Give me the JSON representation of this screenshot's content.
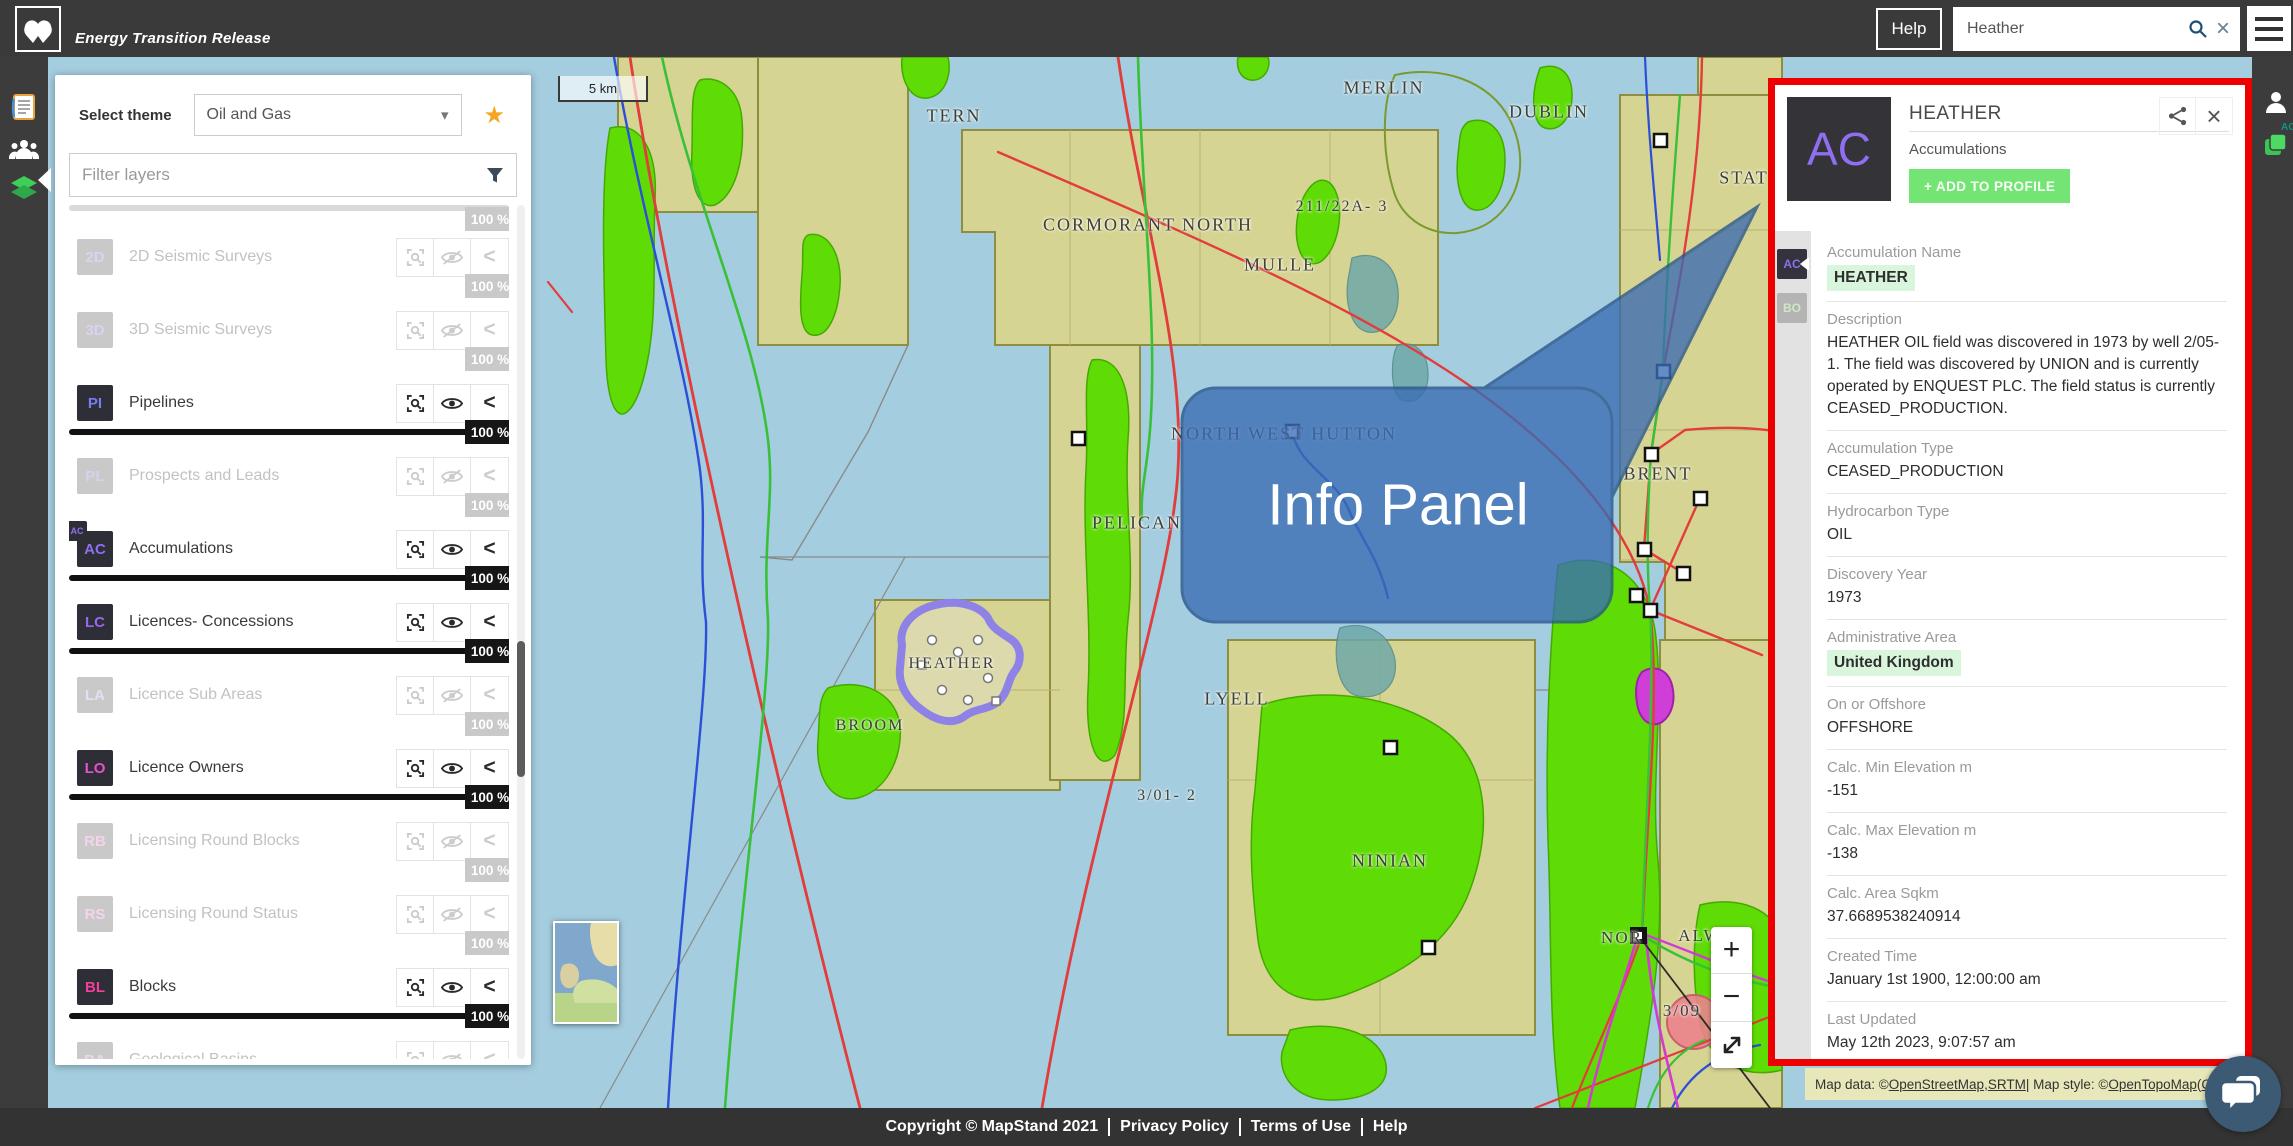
{
  "topbar": {
    "app_title": "Energy Transition Release",
    "help_label": "Help",
    "search": {
      "value": "Heather",
      "placeholder": ""
    }
  },
  "icons": {
    "menu-icon": "hamburger-three-bars",
    "search-icon": "magnifier",
    "clear-icon": "×",
    "dropdown-chevron": "▾",
    "star-icon": "★",
    "filter-icon": "funnel",
    "share-icon": "share-nodes",
    "close-icon": "×",
    "chevron-left": "<",
    "zoom-in": "+",
    "zoom-out": "−",
    "expand-icon": "diagonal-arrows",
    "document-icon": "report-page",
    "people-icon": "user-group",
    "layers-icon": "green-stack",
    "person-icon": "user-silhouette",
    "chat-icon": "speech-bubbles"
  },
  "colors": {
    "accent_green_button": "#74e574",
    "highlight_green": "#d9f6dd",
    "annotation_red": "#ec0000",
    "callout_blue": "#3a6cb4",
    "sea": "#a4cddf",
    "license_block": "#d6d493",
    "field_green": "#5fdc05",
    "selected_purple": "#8e82e6"
  },
  "layers_panel": {
    "select_theme_label": "Select theme",
    "theme_value": "Oil and Gas",
    "filter_placeholder": "Filter layers",
    "partial_row_opacity": "100 %",
    "layers": [
      {
        "code": "2D",
        "name": "2D Seismic Surveys",
        "enabled": false,
        "opacity": "100 %",
        "letter_color": "#dcd2f0"
      },
      {
        "code": "3D",
        "name": "3D Seismic Surveys",
        "enabled": false,
        "opacity": "100 %",
        "letter_color": "#dcd2f0"
      },
      {
        "code": "PI",
        "name": "Pipelines",
        "enabled": true,
        "opacity": "100 %",
        "letter_color": "#7b7bf2"
      },
      {
        "code": "PL",
        "name": "Prospects and Leads",
        "enabled": false,
        "opacity": "100 %",
        "letter_color": "#d8d0ec"
      },
      {
        "code": "AC",
        "name": "Accumulations",
        "enabled": true,
        "opacity": "100 %",
        "letter_color": "#8f6ef0",
        "mini": "AC"
      },
      {
        "code": "LC",
        "name": "Licences- Concessions",
        "enabled": true,
        "opacity": "100 %",
        "letter_color": "#9a66ee"
      },
      {
        "code": "LA",
        "name": "Licence Sub Areas",
        "enabled": false,
        "opacity": "100 %",
        "letter_color": "#e8def4"
      },
      {
        "code": "LO",
        "name": "Licence Owners",
        "enabled": true,
        "opacity": "100 %",
        "letter_color": "#ea4fd2"
      },
      {
        "code": "RB",
        "name": "Licensing Round Blocks",
        "enabled": false,
        "opacity": "100 %",
        "letter_color": "#f4d4ec"
      },
      {
        "code": "RS",
        "name": "Licensing Round Status",
        "enabled": false,
        "opacity": "100 %",
        "letter_color": "#f4d4ec"
      },
      {
        "code": "BL",
        "name": "Blocks",
        "enabled": true,
        "opacity": "100 %",
        "letter_color": "#f23f9b"
      },
      {
        "code": "BA",
        "name": "Geological Basins",
        "enabled": false,
        "opacity": "100 %",
        "letter_color": "#f0d4e8"
      },
      {
        "code": "AA",
        "name": "Administrative Areas",
        "enabled": false,
        "opacity": "100 %",
        "letter_color": "#f0d4e8"
      }
    ]
  },
  "info_panel": {
    "avatar_code": "AC",
    "title": "HEATHER",
    "subtitle": "Accumulations",
    "add_to_profile_label": "+ ADD TO PROFILE",
    "rail": [
      {
        "code": "AC",
        "state": "active"
      },
      {
        "code": "BO",
        "state": "idle"
      }
    ],
    "fields": [
      {
        "label": "Accumulation Name",
        "value": "HEATHER",
        "highlight": true
      },
      {
        "label": "Description",
        "value": "HEATHER OIL field was discovered in 1973 by well 2/05- 1. The field was discovered by UNION and is currently operated by ENQUEST PLC. The field status is currently CEASED_PRODUCTION."
      },
      {
        "label": "Accumulation Type",
        "value": "CEASED_PRODUCTION"
      },
      {
        "label": "Hydrocarbon Type",
        "value": "OIL"
      },
      {
        "label": "Discovery Year",
        "value": "1973"
      },
      {
        "label": "Administrative Area",
        "value": "United Kingdom",
        "highlight": true
      },
      {
        "label": "On or Offshore",
        "value": "OFFSHORE"
      },
      {
        "label": "Calc. Min Elevation m",
        "value": "-151"
      },
      {
        "label": "Calc. Max Elevation m",
        "value": "-138"
      },
      {
        "label": "Calc. Area Sqkm",
        "value": "37.6689538240914"
      },
      {
        "label": "Created Time",
        "value": "January 1st 1900, 12:00:00 am"
      },
      {
        "label": "Last Updated",
        "value": "May 12th 2023, 9:07:57 am"
      },
      {
        "label": "Data Source Tags",
        "value": "Data derived from OGA (https://data-ogauthority.opendata.arcgis.com/datasets/oga-offshore-fields-wgs84)"
      }
    ]
  },
  "map": {
    "scale_label": "5 km",
    "callout_label": "Info Panel",
    "zoom_in": "+",
    "zoom_out": "−",
    "labels": [
      {
        "text": "MERLIN",
        "x": 1384,
        "y": 88,
        "size": 18
      },
      {
        "text": "DUBLIN",
        "x": 1549,
        "y": 112,
        "size": 18
      },
      {
        "text": "TERN",
        "x": 954,
        "y": 116,
        "size": 18
      },
      {
        "text": "211/22A- 3",
        "x": 1342,
        "y": 207,
        "size": 16
      },
      {
        "text": "CORMORANT NORTH",
        "x": 1148,
        "y": 225,
        "size": 18
      },
      {
        "text": "MULLE",
        "x": 1280,
        "y": 265,
        "size": 18
      },
      {
        "text": "STAT",
        "x": 1744,
        "y": 178,
        "size": 18
      },
      {
        "text": "NORTH WEST HUTTON",
        "x": 1284,
        "y": 434,
        "size": 18
      },
      {
        "text": "BRENT",
        "x": 1658,
        "y": 474,
        "size": 18
      },
      {
        "text": "PELICAN",
        "x": 1137,
        "y": 523,
        "size": 18
      },
      {
        "text": "HEATHER",
        "x": 952,
        "y": 664,
        "size": 16
      },
      {
        "text": "BROOM",
        "x": 870,
        "y": 726,
        "size": 16
      },
      {
        "text": "LYELL",
        "x": 1237,
        "y": 699,
        "size": 18
      },
      {
        "text": "3/01- 2",
        "x": 1167,
        "y": 796,
        "size": 16
      },
      {
        "text": "NINIAN",
        "x": 1390,
        "y": 861,
        "size": 18
      },
      {
        "text": "NOR",
        "x": 1622,
        "y": 938,
        "size": 17
      },
      {
        "text": "ALW",
        "x": 1700,
        "y": 936,
        "size": 17
      },
      {
        "text": "3/09",
        "x": 1682,
        "y": 1011,
        "size": 17
      }
    ],
    "attribution": {
      "p1": "Map data: © ",
      "osm": "OpenStreetMap",
      "p2": ", ",
      "srtm": "SRTM",
      "p3": " | Map style: © ",
      "otm": "OpenTopoMap",
      "p4": " (",
      "cc": "CC-B"
    }
  },
  "footer": {
    "copyright": "Copyright © MapStand 2021",
    "privacy": "Privacy Policy",
    "terms": "Terms of Use",
    "help": "Help"
  }
}
